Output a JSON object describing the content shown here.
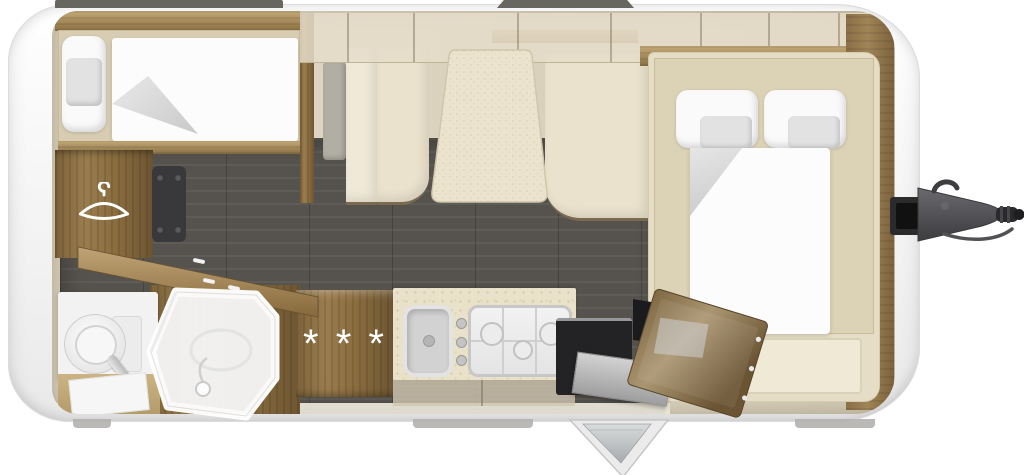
{
  "labels": {
    "drawer_unit_stars": "* * *"
  },
  "colors": {
    "shell": "#f4f4f4",
    "floor": "#56534e",
    "wood_dark": "#8a6d3f",
    "wood_light": "#c2a977",
    "upholstery_cream": "#eae2cc",
    "mattress_beige": "#d8cdb2",
    "bedding_white": "#fcfcfc",
    "counter_speckle": "#e9e1ca",
    "appliance_dark": "#232325",
    "hitch_gray": "#4b4b4e"
  },
  "icons": {
    "hanger": "clothes-hanger-icon",
    "shower": "shower-enclosure-icon",
    "toilet": "toilet-icon",
    "sink": "kitchen-sink-icon",
    "hob": "gas-hob-3-burner-icon",
    "tow_hitch": "tow-hitch-icon",
    "entry_door": "entry-door-open-icon"
  },
  "fixtures": [
    "single-bed-rear",
    "wardrobe",
    "tv-panel",
    "bathroom-vanity",
    "toilet",
    "shower-cubicle",
    "drawer-unit",
    "kitchen-counter",
    "sink",
    "gas-hob",
    "oven-dark-appliance",
    "fridge-open-door",
    "entry-door",
    "dinette-bench-left",
    "dinette-bench-right",
    "dinette-table",
    "french-double-bed",
    "overhead-lockers",
    "front-wardrobe-paneling",
    "tow-hitch"
  ]
}
